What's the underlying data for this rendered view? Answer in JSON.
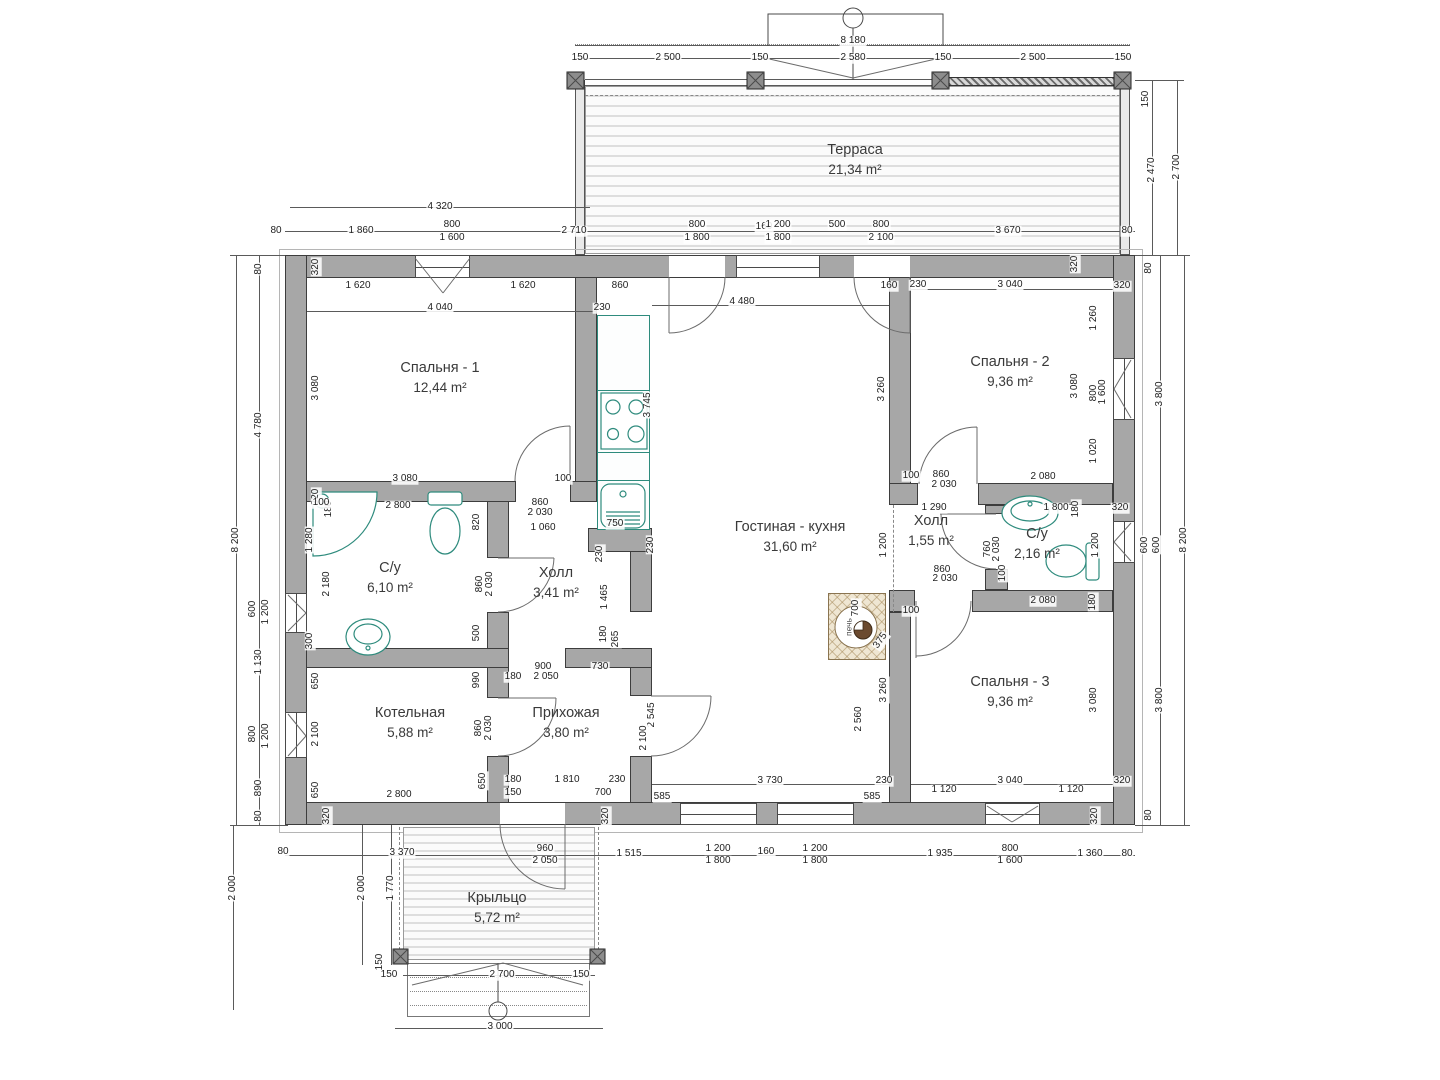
{
  "colors": {
    "wall": "#a7a7a7",
    "fixture_teal": "#2e8b7d",
    "hatch_tan": "#a08250",
    "line": "#5a5a5a"
  },
  "stove": {
    "label": "печь"
  },
  "rooms": [
    {
      "name": "Терраса",
      "area": "21,34 m²",
      "x": 855,
      "y": 160
    },
    {
      "name": "Спальня - 1",
      "area": "12,44 m²",
      "x": 440,
      "y": 378
    },
    {
      "name": "Спальня - 2",
      "area": "9,36 m²",
      "x": 1010,
      "y": 372
    },
    {
      "name": "Гостиная - кухня",
      "area": "31,60 m²",
      "x": 790,
      "y": 537
    },
    {
      "name": "С/у",
      "area": "6,10 m²",
      "x": 390,
      "y": 578
    },
    {
      "name": "Холл",
      "area": "3,41 m²",
      "x": 556,
      "y": 583
    },
    {
      "name": "Холл",
      "area": "1,55 m²",
      "x": 931,
      "y": 531
    },
    {
      "name": "С/у",
      "area": "2,16 m²",
      "x": 1037,
      "y": 544
    },
    {
      "name": "Котельная",
      "area": "5,88 m²",
      "x": 410,
      "y": 723
    },
    {
      "name": "Прихожая",
      "area": "3,80 m²",
      "x": 566,
      "y": 723
    },
    {
      "name": "Спальня - 3",
      "area": "9,36 m²",
      "x": 1010,
      "y": 692
    },
    {
      "name": "Крыльцо",
      "area": "5,72 m²",
      "x": 497,
      "y": 908
    }
  ],
  "dims": [
    {
      "t": "8 180",
      "x": 853,
      "y": 41
    },
    {
      "t": "150",
      "x": 580,
      "y": 58
    },
    {
      "t": "2 500",
      "x": 668,
      "y": 58
    },
    {
      "t": "150",
      "x": 760,
      "y": 58
    },
    {
      "t": "2 580",
      "x": 853,
      "y": 58
    },
    {
      "t": "150",
      "x": 943,
      "y": 58
    },
    {
      "t": "2 500",
      "x": 1033,
      "y": 58
    },
    {
      "t": "150",
      "x": 1123,
      "y": 58
    },
    {
      "t": "150",
      "x": 1146,
      "y": 99,
      "r": 1
    },
    {
      "t": "2 470",
      "x": 1152,
      "y": 170,
      "r": 1
    },
    {
      "t": "2 700",
      "x": 1177,
      "y": 167,
      "r": 1
    },
    {
      "t": "4 320",
      "x": 440,
      "y": 207
    },
    {
      "t": "80",
      "x": 276,
      "y": 231
    },
    {
      "t": "1 860",
      "x": 361,
      "y": 231
    },
    {
      "t": "800",
      "x": 452,
      "y": 225
    },
    {
      "t": "1 600",
      "x": 452,
      "y": 238
    },
    {
      "t": "2 710",
      "x": 574,
      "y": 231
    },
    {
      "t": "800",
      "x": 697,
      "y": 225
    },
    {
      "t": "1 800",
      "x": 697,
      "y": 238
    },
    {
      "t": "160",
      "x": 764,
      "y": 227
    },
    {
      "t": "1 200",
      "x": 778,
      "y": 225
    },
    {
      "t": "1 800",
      "x": 778,
      "y": 238
    },
    {
      "t": "500",
      "x": 837,
      "y": 225
    },
    {
      "t": "800",
      "x": 881,
      "y": 225
    },
    {
      "t": "2 100",
      "x": 881,
      "y": 238
    },
    {
      "t": "3 670",
      "x": 1008,
      "y": 231
    },
    {
      "t": "80",
      "x": 1127,
      "y": 231
    },
    {
      "t": "8 200",
      "x": 236,
      "y": 540,
      "r": 1
    },
    {
      "t": "80",
      "x": 259,
      "y": 269,
      "r": 1
    },
    {
      "t": "4 780",
      "x": 259,
      "y": 425,
      "r": 1
    },
    {
      "t": "600",
      "x": 253,
      "y": 609,
      "r": 1
    },
    {
      "t": "1 200",
      "x": 266,
      "y": 612,
      "r": 1
    },
    {
      "t": "1 130",
      "x": 259,
      "y": 662,
      "r": 1
    },
    {
      "t": "800",
      "x": 253,
      "y": 734,
      "r": 1
    },
    {
      "t": "1 200",
      "x": 266,
      "y": 736,
      "r": 1
    },
    {
      "t": "890",
      "x": 259,
      "y": 788,
      "r": 1
    },
    {
      "t": "80",
      "x": 259,
      "y": 816,
      "r": 1
    },
    {
      "t": "320",
      "x": 316,
      "y": 267,
      "r": 1
    },
    {
      "t": "3 080",
      "x": 316,
      "y": 388,
      "r": 1
    },
    {
      "t": "320",
      "x": 316,
      "y": 497,
      "r": 1
    },
    {
      "t": "1 280",
      "x": 310,
      "y": 540,
      "r": 1
    },
    {
      "t": "180",
      "x": 329,
      "y": 509,
      "r": 1
    },
    {
      "t": "100",
      "x": 321,
      "y": 503
    },
    {
      "t": "2 180",
      "x": 327,
      "y": 584,
      "r": 1
    },
    {
      "t": "300",
      "x": 310,
      "y": 641,
      "r": 1
    },
    {
      "t": "650",
      "x": 316,
      "y": 681,
      "r": 1
    },
    {
      "t": "2 100",
      "x": 316,
      "y": 734,
      "r": 1
    },
    {
      "t": "650",
      "x": 316,
      "y": 790,
      "r": 1
    },
    {
      "t": "320",
      "x": 327,
      "y": 816,
      "r": 1
    },
    {
      "t": "1 620",
      "x": 358,
      "y": 286
    },
    {
      "t": "1 620",
      "x": 523,
      "y": 286
    },
    {
      "t": "4 040",
      "x": 440,
      "y": 308
    },
    {
      "t": "3 080",
      "x": 405,
      "y": 479
    },
    {
      "t": "100",
      "x": 563,
      "y": 479
    },
    {
      "t": "860",
      "x": 540,
      "y": 503
    },
    {
      "t": "2 030",
      "x": 540,
      "y": 513
    },
    {
      "t": "1 060",
      "x": 543,
      "y": 528
    },
    {
      "t": "860",
      "x": 620,
      "y": 286
    },
    {
      "t": "230",
      "x": 602,
      "y": 308
    },
    {
      "t": "3 745",
      "x": 648,
      "y": 405,
      "r": 1
    },
    {
      "t": "750",
      "x": 615,
      "y": 524
    },
    {
      "t": "230",
      "x": 600,
      "y": 554,
      "r": 1
    },
    {
      "t": "230",
      "x": 651,
      "y": 545,
      "r": 1
    },
    {
      "t": "4 480",
      "x": 742,
      "y": 302
    },
    {
      "t": "3 260",
      "x": 882,
      "y": 389,
      "r": 1
    },
    {
      "t": "1 200",
      "x": 884,
      "y": 545,
      "r": 1
    },
    {
      "t": "2 545",
      "x": 652,
      "y": 715,
      "r": 1
    },
    {
      "t": "2 100",
      "x": 644,
      "y": 738,
      "r": 1
    },
    {
      "t": "2 560",
      "x": 859,
      "y": 719,
      "r": 1
    },
    {
      "t": "3 260",
      "x": 884,
      "y": 690,
      "r": 1
    },
    {
      "t": "3 730",
      "x": 770,
      "y": 781
    },
    {
      "t": "585",
      "x": 662,
      "y": 797
    },
    {
      "t": "585",
      "x": 872,
      "y": 797
    },
    {
      "t": "230",
      "x": 884,
      "y": 781
    },
    {
      "t": "700",
      "x": 856,
      "y": 608,
      "r": 1
    },
    {
      "t": "375",
      "x": 881,
      "y": 641,
      "r": 2
    },
    {
      "t": "2 800",
      "x": 398,
      "y": 506
    },
    {
      "t": "820",
      "x": 477,
      "y": 522,
      "r": 1
    },
    {
      "t": "860",
      "x": 480,
      "y": 584,
      "r": 1
    },
    {
      "t": "2 030",
      "x": 490,
      "y": 584,
      "r": 1
    },
    {
      "t": "500",
      "x": 477,
      "y": 633,
      "r": 1
    },
    {
      "t": "990",
      "x": 477,
      "y": 680,
      "r": 1
    },
    {
      "t": "1 465",
      "x": 605,
      "y": 597,
      "r": 1
    },
    {
      "t": "180",
      "x": 604,
      "y": 634,
      "r": 1
    },
    {
      "t": "265",
      "x": 616,
      "y": 639,
      "r": 1
    },
    {
      "t": "900",
      "x": 543,
      "y": 667
    },
    {
      "t": "2 050",
      "x": 546,
      "y": 677
    },
    {
      "t": "730",
      "x": 600,
      "y": 667
    },
    {
      "t": "180",
      "x": 513,
      "y": 677
    },
    {
      "t": "860",
      "x": 479,
      "y": 728,
      "r": 1
    },
    {
      "t": "2 030",
      "x": 489,
      "y": 728,
      "r": 1
    },
    {
      "t": "2 800",
      "x": 399,
      "y": 795
    },
    {
      "t": "650",
      "x": 483,
      "y": 781,
      "r": 1
    },
    {
      "t": "180",
      "x": 513,
      "y": 780
    },
    {
      "t": "1 810",
      "x": 567,
      "y": 780
    },
    {
      "t": "230",
      "x": 617,
      "y": 780
    },
    {
      "t": "150",
      "x": 513,
      "y": 793
    },
    {
      "t": "700",
      "x": 603,
      "y": 793
    },
    {
      "t": "320",
      "x": 606,
      "y": 816,
      "r": 1
    },
    {
      "t": "80",
      "x": 283,
      "y": 852
    },
    {
      "t": "3 370",
      "x": 402,
      "y": 853
    },
    {
      "t": "960",
      "x": 545,
      "y": 849
    },
    {
      "t": "2 050",
      "x": 545,
      "y": 861
    },
    {
      "t": "1 515",
      "x": 629,
      "y": 854
    },
    {
      "t": "1 200",
      "x": 718,
      "y": 849
    },
    {
      "t": "1 800",
      "x": 718,
      "y": 861
    },
    {
      "t": "160",
      "x": 766,
      "y": 852
    },
    {
      "t": "1 200",
      "x": 815,
      "y": 849
    },
    {
      "t": "1 800",
      "x": 815,
      "y": 861
    },
    {
      "t": "1 935",
      "x": 940,
      "y": 854
    },
    {
      "t": "800",
      "x": 1010,
      "y": 849
    },
    {
      "t": "1 600",
      "x": 1010,
      "y": 861
    },
    {
      "t": "1 360",
      "x": 1090,
      "y": 854
    },
    {
      "t": "80",
      "x": 1127,
      "y": 854
    },
    {
      "t": "2 000",
      "x": 233,
      "y": 888,
      "r": 1
    },
    {
      "t": "2 000",
      "x": 362,
      "y": 888,
      "r": 1
    },
    {
      "t": "1 770",
      "x": 391,
      "y": 888,
      "r": 1
    },
    {
      "t": "150",
      "x": 380,
      "y": 962,
      "r": 1
    },
    {
      "t": "150",
      "x": 389,
      "y": 975
    },
    {
      "t": "2 700",
      "x": 502,
      "y": 975
    },
    {
      "t": "150",
      "x": 581,
      "y": 975
    },
    {
      "t": "3 000",
      "x": 500,
      "y": 1027
    },
    {
      "t": "160",
      "x": 889,
      "y": 286
    },
    {
      "t": "230",
      "x": 918,
      "y": 285
    },
    {
      "t": "3 040",
      "x": 1010,
      "y": 285
    },
    {
      "t": "320",
      "x": 1122,
      "y": 286
    },
    {
      "t": "320",
      "x": 1075,
      "y": 264,
      "r": 1
    },
    {
      "t": "3 080",
      "x": 1075,
      "y": 386,
      "r": 1
    },
    {
      "t": "1 260",
      "x": 1094,
      "y": 318,
      "r": 1
    },
    {
      "t": "800",
      "x": 1094,
      "y": 393,
      "r": 1
    },
    {
      "t": "1 600",
      "x": 1103,
      "y": 392,
      "r": 1
    },
    {
      "t": "1 020",
      "x": 1094,
      "y": 451,
      "r": 1
    },
    {
      "t": "2 080",
      "x": 1043,
      "y": 477
    },
    {
      "t": "100",
      "x": 911,
      "y": 476
    },
    {
      "t": "860",
      "x": 941,
      "y": 475
    },
    {
      "t": "2 030",
      "x": 944,
      "y": 485
    },
    {
      "t": "1 290",
      "x": 934,
      "y": 508
    },
    {
      "t": "1 800",
      "x": 1056,
      "y": 508
    },
    {
      "t": "180",
      "x": 1076,
      "y": 509,
      "r": 1
    },
    {
      "t": "320",
      "x": 1120,
      "y": 508
    },
    {
      "t": "80",
      "x": 1149,
      "y": 268,
      "r": 1
    },
    {
      "t": "3 800",
      "x": 1160,
      "y": 394,
      "r": 1
    },
    {
      "t": "600",
      "x": 1145,
      "y": 545,
      "r": 1
    },
    {
      "t": "600",
      "x": 1157,
      "y": 545,
      "r": 1
    },
    {
      "t": "8 200",
      "x": 1184,
      "y": 540,
      "r": 1
    },
    {
      "t": "3 800",
      "x": 1160,
      "y": 700,
      "r": 1
    },
    {
      "t": "80",
      "x": 1149,
      "y": 815,
      "r": 1
    },
    {
      "t": "760",
      "x": 988,
      "y": 549,
      "r": 1
    },
    {
      "t": "2 030",
      "x": 997,
      "y": 549,
      "r": 1
    },
    {
      "t": "860",
      "x": 942,
      "y": 570
    },
    {
      "t": "2 030",
      "x": 945,
      "y": 579
    },
    {
      "t": "100",
      "x": 1003,
      "y": 573,
      "r": 1
    },
    {
      "t": "1 200",
      "x": 1096,
      "y": 545,
      "r": 1
    },
    {
      "t": "100",
      "x": 911,
      "y": 611
    },
    {
      "t": "2 080",
      "x": 1043,
      "y": 601
    },
    {
      "t": "180",
      "x": 1093,
      "y": 602,
      "r": 1
    },
    {
      "t": "3 080",
      "x": 1094,
      "y": 700,
      "r": 1
    },
    {
      "t": "3 040",
      "x": 1010,
      "y": 781
    },
    {
      "t": "320",
      "x": 1122,
      "y": 781
    },
    {
      "t": "1 120",
      "x": 944,
      "y": 790
    },
    {
      "t": "1 120",
      "x": 1071,
      "y": 790
    },
    {
      "t": "320",
      "x": 1095,
      "y": 816,
      "r": 1
    }
  ]
}
